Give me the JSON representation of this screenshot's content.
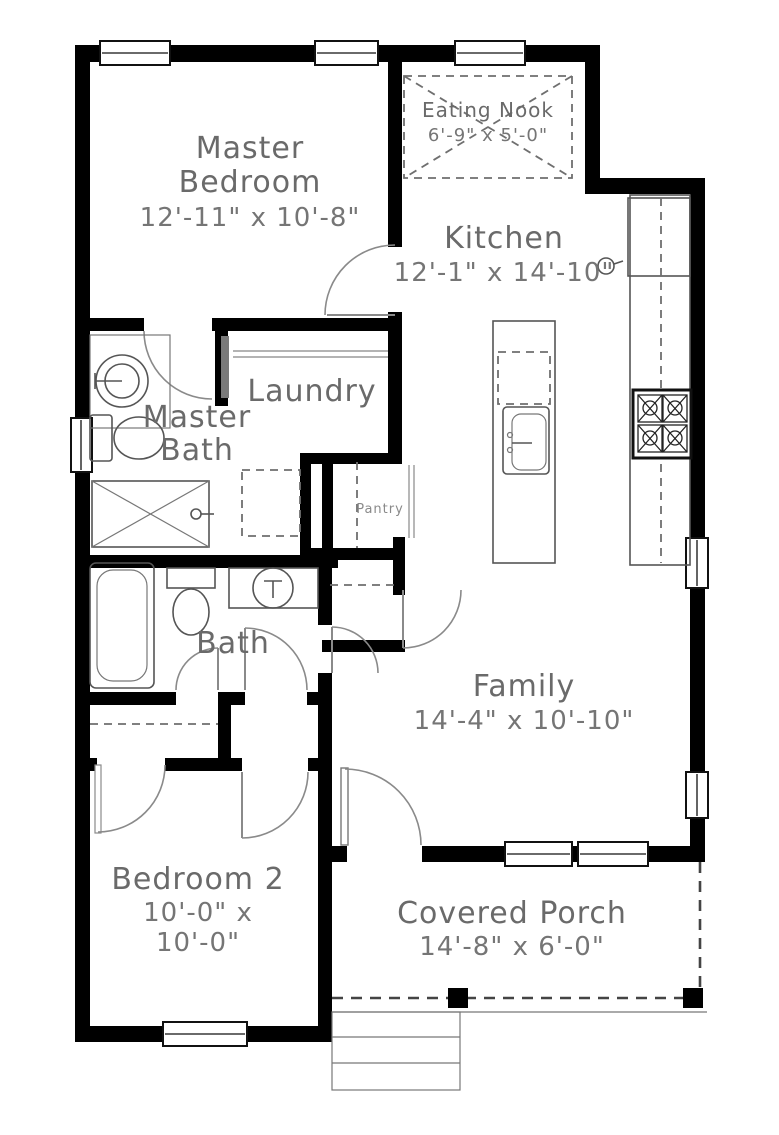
{
  "drawing_type": "residential-floor-plan",
  "rooms": {
    "master_bedroom": {
      "line1": "Master",
      "line2": "Bedroom",
      "dims": "12'-11\" x 10'-8\""
    },
    "eating_nook": {
      "name": "Eating Nook",
      "dims": "6'-9\" x 5'-0\""
    },
    "kitchen": {
      "name": "Kitchen",
      "dims": "12'-1\" x 14'-10\""
    },
    "laundry": {
      "name": "Laundry"
    },
    "master_bath": {
      "line1": "Master",
      "line2": "Bath"
    },
    "pantry": {
      "name": "Pantry"
    },
    "bath": {
      "name": "Bath"
    },
    "family": {
      "name": "Family",
      "dims": "14'-4\" x 10'-10\""
    },
    "bedroom_2": {
      "name": "Bedroom 2",
      "dims_line1": "10'-0\" x",
      "dims_line2": "10'-0\""
    },
    "covered_porch": {
      "name": "Covered Porch",
      "dims": "14'-8\" x 6'-0\""
    }
  },
  "fixtures": [
    "pedestal-sink",
    "toilet",
    "shower",
    "bathtub",
    "vanity-sink",
    "washer-dryer-space",
    "closet-rod",
    "kitchen-island",
    "island-sink",
    "dishwasher",
    "refrigerator",
    "range-stove",
    "eating-nook-table",
    "porch-posts",
    "porch-steps",
    "windows",
    "door-swings"
  ],
  "colors": {
    "wall": "#000000",
    "fixture_line": "#555555",
    "label_text": "#6a6a6a",
    "dashed_line": "#6f6f6f",
    "background": "#ffffff"
  }
}
